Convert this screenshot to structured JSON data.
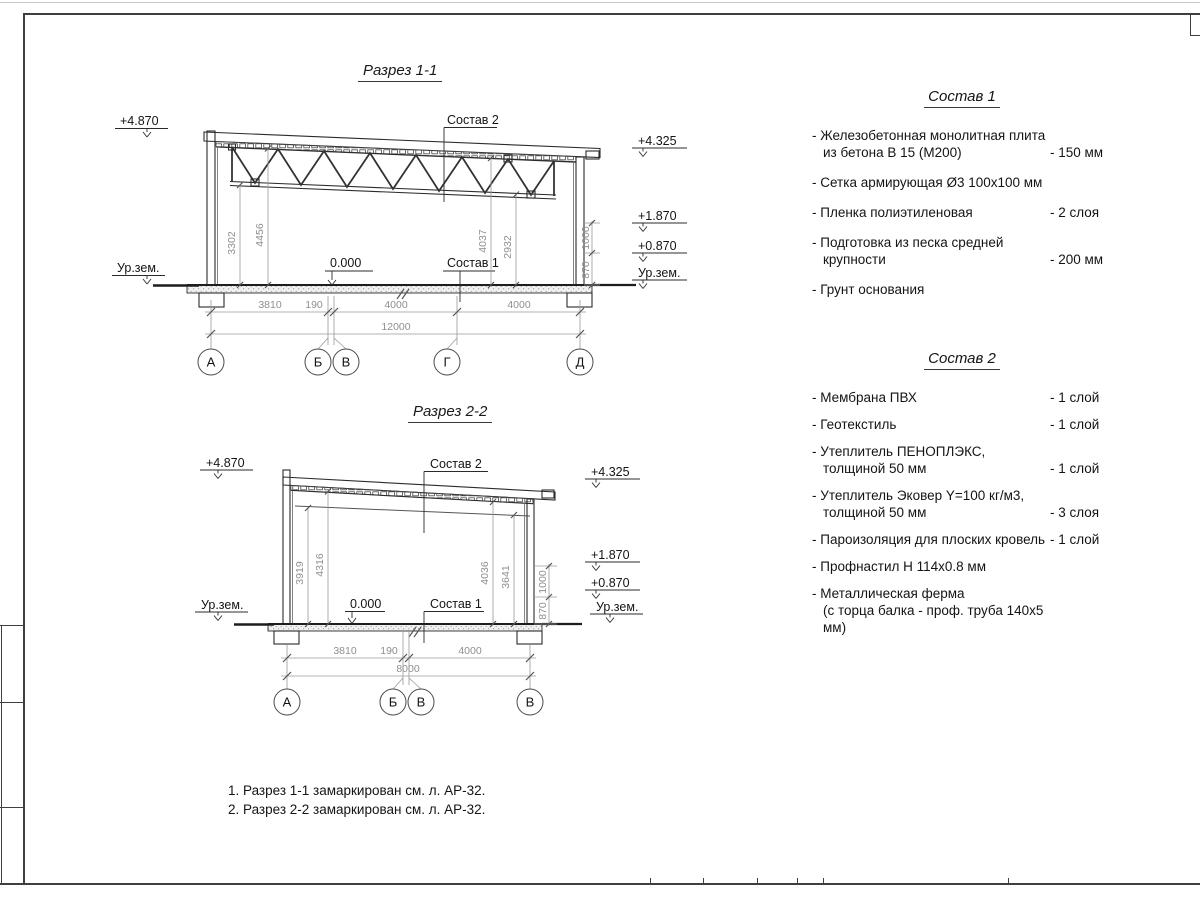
{
  "sections": {
    "s1": {
      "title": "Разрез 1-1",
      "labels": {
        "c2": "Состав 2",
        "c1": "Состав 1",
        "zero": "0.000"
      },
      "elev": {
        "lt": "+4.870",
        "lg": "Ур.зем.",
        "r1": "+4.325",
        "r2": "+1.870",
        "r3": "+0.870",
        "rg": "Ур.зем."
      },
      "vdims": [
        "3302",
        "4456",
        "4037",
        "2932"
      ],
      "walldims": [
        "1000",
        "870"
      ],
      "hdims": [
        "3810",
        "190",
        "4000",
        "4000"
      ],
      "total": "12000",
      "axes": [
        "А",
        "Б",
        "В",
        "Г",
        "Д"
      ]
    },
    "s2": {
      "title": "Разрез 2-2",
      "labels": {
        "c2": "Состав 2",
        "c1": "Состав 1",
        "zero": "0.000"
      },
      "elev": {
        "lt": "+4.870",
        "lg": "Ур.зем.",
        "r1": "+4.325",
        "r2": "+1.870",
        "r3": "+0.870",
        "rg": "Ур.зем."
      },
      "vdims": [
        "3919",
        "4316",
        "4036",
        "3641"
      ],
      "walldims": [
        "1000",
        "870"
      ],
      "hdims": [
        "3810",
        "190",
        "4000"
      ],
      "total": "8000",
      "axes": [
        "А",
        "Б",
        "В",
        "В"
      ]
    }
  },
  "compositions": [
    {
      "title": "Состав 1",
      "items": [
        {
          "name": "- Железобетонная  монолитная плита\nиз бетона В 15 (М200)",
          "value": "- 150 мм"
        },
        {
          "name": "- Сетка армирующая Ø3 100х100 мм",
          "value": ""
        },
        {
          "name": "- Пленка полиэтиленовая",
          "value": "-  2 слоя"
        },
        {
          "name": "- Подготовка из песка средней\nкрупности",
          "value": "- 200 мм"
        },
        {
          "name": "- Грунт основания",
          "value": ""
        }
      ]
    },
    {
      "title": "Состав 2",
      "items": [
        {
          "name": "- Мембрана ПВХ",
          "value": "- 1 слой"
        },
        {
          "name": "- Геотекстиль",
          "value": "- 1 слой"
        },
        {
          "name": "- Утеплитель ПЕНОПЛЭКС,\nтолщиной 50 мм",
          "value": "- 1 слой"
        },
        {
          "name": "- Утеплитель Эковер Y=100 кг/м3,\nтолщиной 50 мм",
          "value": "- 3 слоя"
        },
        {
          "name": "- Пароизоляция для плоских кровель",
          "value": "- 1 слой"
        },
        {
          "name": "- Профнастил Н 114х0.8 мм",
          "value": ""
        },
        {
          "name": "- Металлическая ферма\n(с торца балка - проф. труба 140х5 мм)",
          "value": ""
        }
      ]
    }
  ],
  "notes": [
    "1. Разрез 1-1 замаркирован см. л. АР-32.",
    "2. Разрез 2-2 замаркирован см. л. АР-32."
  ]
}
